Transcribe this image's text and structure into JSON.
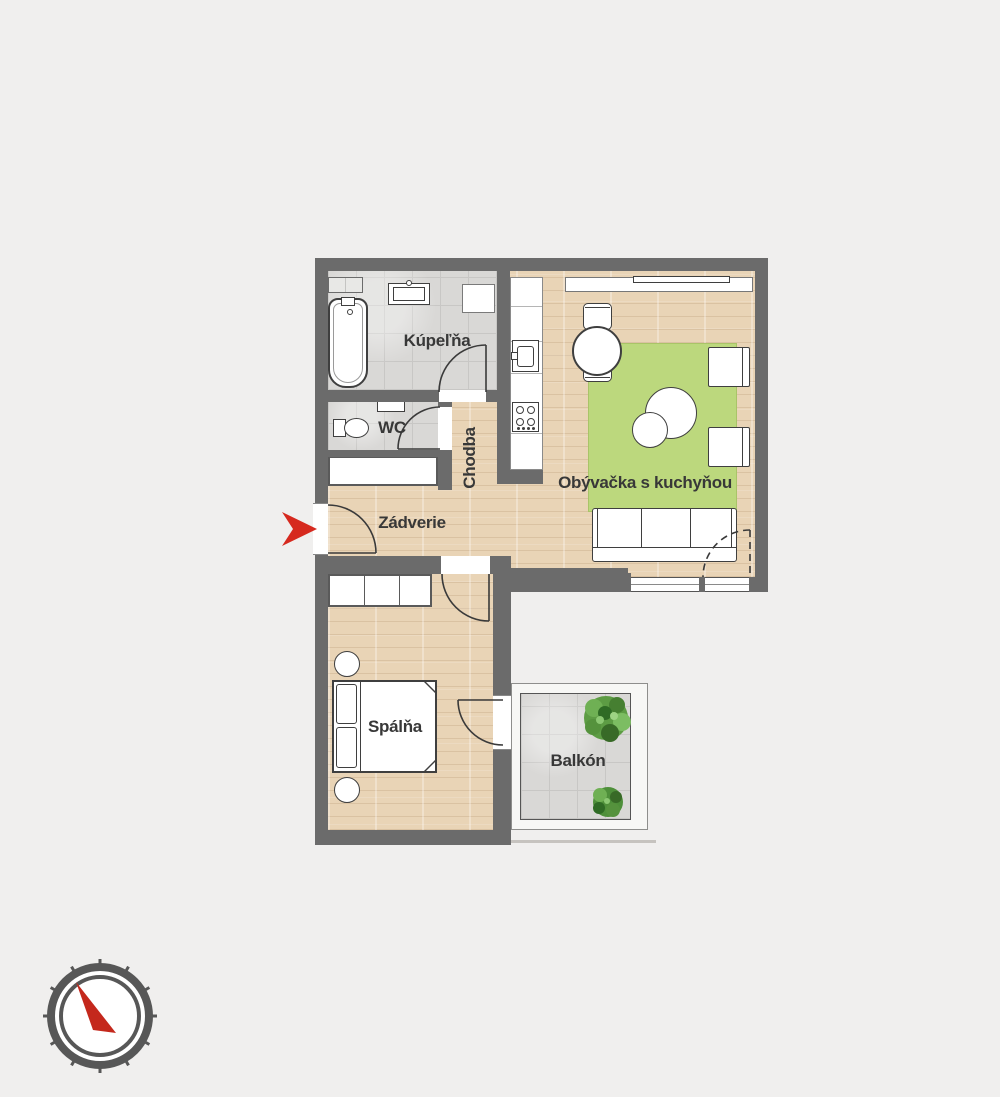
{
  "palette": {
    "background": "#f0efee",
    "wall": "#6b6b6b",
    "wood_floor": "#e9d4b6",
    "tile_floor": "#d9d8d6",
    "rug_green": "#bcd87d",
    "accent_red": "#d6291e",
    "label_text": "#383838"
  },
  "plan": {
    "rooms": [
      {
        "id": "kupelna",
        "label": "Kúpeľňa"
      },
      {
        "id": "wc",
        "label": "WC"
      },
      {
        "id": "chodba",
        "label": "Chodba"
      },
      {
        "id": "zadverie",
        "label": "Zádverie"
      },
      {
        "id": "obyvacka",
        "label": "Obývačka s kuchyňou"
      },
      {
        "id": "spalna",
        "label": "Spálňa"
      },
      {
        "id": "balkon",
        "label": "Balkón"
      }
    ],
    "icons": [
      "entrance-arrow-icon",
      "compass-icon",
      "bathtub-icon",
      "washbasin-icon",
      "toilet-icon",
      "kitchen-sink-icon",
      "stove-icon",
      "dining-table-icon",
      "sofa-icon",
      "coffee-table-icon",
      "armchair-icon",
      "bed-icon",
      "wardrobe-icon",
      "plant-icon",
      "tv-icon"
    ]
  }
}
